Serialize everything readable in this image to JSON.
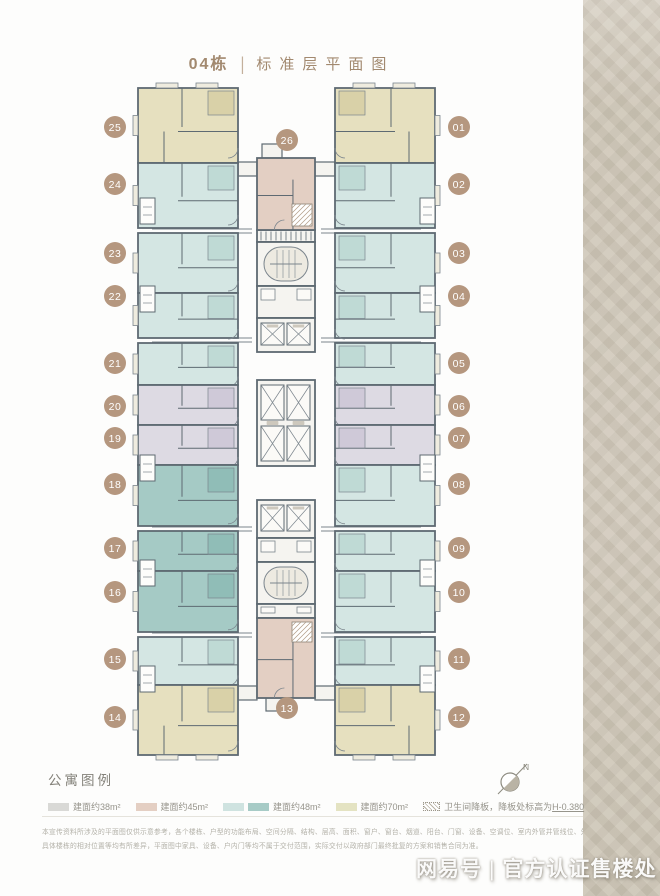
{
  "title": {
    "building": "04栋",
    "separator": "|",
    "name": "标准层平面图"
  },
  "legend": {
    "title": "公寓图例",
    "items": [
      {
        "label": "建面约38m²",
        "swatches": [
          "#d9d9d6"
        ]
      },
      {
        "label": "建面约45m²",
        "swatches": [
          "#e4cfc3"
        ]
      },
      {
        "label": "建面约48m²",
        "swatches": [
          "#cfe3e0",
          "#a7cbc6"
        ]
      },
      {
        "label": "建面约70m²",
        "swatches": [
          "#e4e3c2"
        ]
      },
      {
        "label": "卫生间降板，降板处标高为",
        "underlined": "H-0.380",
        "swatches": [
          "hatch"
        ]
      }
    ]
  },
  "compass": {
    "label": "N"
  },
  "disclaimer": {
    "line1": "本宣传资料所涉及的平面图仅供示意参考，各个楼栋、户型的功能布局、空间分隔、结构、层高、面积、窗户、窗台、烟道、阳台、门窗、设备、空调位、室内外管井管线位、外立面材质颜色、",
    "line2": "具体楼栋的相对位置等均有所差异，平面图中家具、设备、户内门等均不属于交付范围，实际交付以政府部门最终批复的方案和销售合同为准。"
  },
  "watermark": {
    "source": "网易号",
    "separator": "|",
    "text": "官方认证售楼处"
  },
  "colors": {
    "wall": "#5e6a72",
    "innerLine": "#7b858d",
    "coreFill": "#f5f4f0",
    "badge": "#b5977f",
    "badgeText": "#ffffff",
    "unitFill": {
      "70": "#e6e0bf",
      "48L": "#d4e6e3",
      "48D": "#a5cac5",
      "38": "#dddae3",
      "45": "#e3cfc3"
    },
    "unitDark": {
      "70": "#d9d1a8",
      "48L": "#bfdad5",
      "48D": "#90bdb7",
      "38": "#cfc9d8",
      "45": "#d5bcab"
    }
  },
  "plan": {
    "units": [
      {
        "no": "25",
        "fill": "70",
        "x": 138,
        "y": 88,
        "w": 100,
        "h": 75,
        "side": "left",
        "cap": "top",
        "badge": {
          "x": 115,
          "y": 127
        }
      },
      {
        "no": "24",
        "fill": "48L",
        "x": 138,
        "y": 163,
        "w": 100,
        "h": 65,
        "side": "left",
        "badge": {
          "x": 115,
          "y": 184
        }
      },
      {
        "no": "23",
        "fill": "48L",
        "x": 138,
        "y": 233,
        "w": 100,
        "h": 60,
        "side": "left",
        "badge": {
          "x": 115,
          "y": 253
        }
      },
      {
        "no": "22",
        "fill": "48L",
        "x": 138,
        "y": 293,
        "w": 100,
        "h": 45,
        "side": "left",
        "badge": {
          "x": 115,
          "y": 296
        }
      },
      {
        "no": "21",
        "fill": "48L",
        "x": 138,
        "y": 343,
        "w": 100,
        "h": 42,
        "side": "left",
        "badge": {
          "x": 115,
          "y": 363
        }
      },
      {
        "no": "20",
        "fill": "38",
        "x": 138,
        "y": 385,
        "w": 100,
        "h": 40,
        "side": "left",
        "badge": {
          "x": 115,
          "y": 406
        }
      },
      {
        "no": "19",
        "fill": "38",
        "x": 138,
        "y": 425,
        "w": 100,
        "h": 40,
        "side": "left",
        "badge": {
          "x": 115,
          "y": 438
        }
      },
      {
        "no": "18",
        "fill": "48D",
        "x": 138,
        "y": 465,
        "w": 100,
        "h": 61,
        "side": "left",
        "badge": {
          "x": 115,
          "y": 484
        }
      },
      {
        "no": "17",
        "fill": "48D",
        "x": 138,
        "y": 531,
        "w": 100,
        "h": 40,
        "side": "left",
        "badge": {
          "x": 115,
          "y": 548
        }
      },
      {
        "no": "16",
        "fill": "48D",
        "x": 138,
        "y": 571,
        "w": 100,
        "h": 61,
        "side": "left",
        "badge": {
          "x": 115,
          "y": 592
        }
      },
      {
        "no": "15",
        "fill": "48L",
        "x": 138,
        "y": 637,
        "w": 100,
        "h": 48,
        "side": "left",
        "badge": {
          "x": 115,
          "y": 659
        }
      },
      {
        "no": "14",
        "fill": "70",
        "x": 138,
        "y": 685,
        "w": 100,
        "h": 70,
        "side": "left",
        "cap": "bottom",
        "badge": {
          "x": 115,
          "y": 717
        }
      },
      {
        "no": "01",
        "fill": "70",
        "x": 335,
        "y": 88,
        "w": 100,
        "h": 75,
        "side": "right",
        "cap": "top",
        "badge": {
          "x": 459,
          "y": 127
        }
      },
      {
        "no": "02",
        "fill": "48L",
        "x": 335,
        "y": 163,
        "w": 100,
        "h": 65,
        "side": "right",
        "badge": {
          "x": 459,
          "y": 184
        }
      },
      {
        "no": "03",
        "fill": "48L",
        "x": 335,
        "y": 233,
        "w": 100,
        "h": 60,
        "side": "right",
        "badge": {
          "x": 459,
          "y": 253
        }
      },
      {
        "no": "04",
        "fill": "48L",
        "x": 335,
        "y": 293,
        "w": 100,
        "h": 45,
        "side": "right",
        "badge": {
          "x": 459,
          "y": 296
        }
      },
      {
        "no": "05",
        "fill": "48L",
        "x": 335,
        "y": 343,
        "w": 100,
        "h": 42,
        "side": "right",
        "badge": {
          "x": 459,
          "y": 363
        }
      },
      {
        "no": "06",
        "fill": "38",
        "x": 335,
        "y": 385,
        "w": 100,
        "h": 40,
        "side": "right",
        "badge": {
          "x": 459,
          "y": 406
        }
      },
      {
        "no": "07",
        "fill": "38",
        "x": 335,
        "y": 425,
        "w": 100,
        "h": 40,
        "side": "right",
        "badge": {
          "x": 459,
          "y": 438
        }
      },
      {
        "no": "08",
        "fill": "48L",
        "x": 335,
        "y": 465,
        "w": 100,
        "h": 61,
        "side": "right",
        "badge": {
          "x": 459,
          "y": 484
        }
      },
      {
        "no": "09",
        "fill": "48L",
        "x": 335,
        "y": 531,
        "w": 100,
        "h": 40,
        "side": "right",
        "badge": {
          "x": 459,
          "y": 548
        }
      },
      {
        "no": "10",
        "fill": "48L",
        "x": 335,
        "y": 571,
        "w": 100,
        "h": 61,
        "side": "right",
        "badge": {
          "x": 459,
          "y": 592
        }
      },
      {
        "no": "11",
        "fill": "48L",
        "x": 335,
        "y": 637,
        "w": 100,
        "h": 48,
        "side": "right",
        "badge": {
          "x": 459,
          "y": 659
        }
      },
      {
        "no": "12",
        "fill": "70",
        "x": 335,
        "y": 685,
        "w": 100,
        "h": 70,
        "side": "right",
        "cap": "bottom",
        "badge": {
          "x": 459,
          "y": 717
        }
      },
      {
        "no": "26",
        "fill": "45",
        "x": 257,
        "y": 158,
        "w": 58,
        "h": 72,
        "side": "center",
        "badge": {
          "x": 287,
          "y": 140
        }
      },
      {
        "no": "13",
        "fill": "45",
        "x": 257,
        "y": 618,
        "w": 58,
        "h": 80,
        "side": "center",
        "badge": {
          "x": 287,
          "y": 708
        }
      }
    ],
    "core": [
      {
        "kind": "louver",
        "x": 257,
        "y": 230,
        "w": 58,
        "h": 12
      },
      {
        "kind": "stair",
        "x": 257,
        "y": 242,
        "w": 58,
        "h": 44
      },
      {
        "kind": "lobby",
        "x": 257,
        "y": 286,
        "w": 58,
        "h": 32
      },
      {
        "kind": "elev2",
        "x": 257,
        "y": 318,
        "w": 58,
        "h": 34
      },
      {
        "kind": "elev4",
        "x": 257,
        "y": 380,
        "w": 58,
        "h": 86
      },
      {
        "kind": "elev2",
        "x": 257,
        "y": 500,
        "w": 58,
        "h": 38
      },
      {
        "kind": "lobby",
        "x": 257,
        "y": 538,
        "w": 58,
        "h": 24
      },
      {
        "kind": "stair",
        "x": 257,
        "y": 562,
        "w": 58,
        "h": 42
      },
      {
        "kind": "lobby",
        "x": 257,
        "y": 604,
        "w": 58,
        "h": 14
      }
    ],
    "bridges": [
      {
        "x": 238,
        "y": 162,
        "w": 19,
        "h": 14
      },
      {
        "x": 315,
        "y": 162,
        "w": 20,
        "h": 14
      },
      {
        "x": 238,
        "y": 686,
        "w": 19,
        "h": 14
      },
      {
        "x": 315,
        "y": 686,
        "w": 20,
        "h": 14
      },
      {
        "x": 262,
        "y": 144,
        "w": 20,
        "h": 14
      },
      {
        "x": 266,
        "y": 698,
        "w": 22,
        "h": 13
      }
    ],
    "corridors": [
      {
        "y": 229,
        "x1": 152,
        "x2": 252
      },
      {
        "y": 229,
        "x1": 321,
        "x2": 421
      },
      {
        "y": 338,
        "x1": 152,
        "x2": 252
      },
      {
        "y": 338,
        "x1": 321,
        "x2": 421
      },
      {
        "y": 527,
        "x1": 152,
        "x2": 252
      },
      {
        "y": 527,
        "x1": 321,
        "x2": 421
      },
      {
        "y": 633,
        "x1": 152,
        "x2": 252
      },
      {
        "y": 633,
        "x1": 321,
        "x2": 421
      }
    ],
    "shafts": [
      {
        "x": 140,
        "y": 198
      },
      {
        "x": 140,
        "y": 286
      },
      {
        "x": 140,
        "y": 455
      },
      {
        "x": 140,
        "y": 560
      },
      {
        "x": 140,
        "y": 666
      },
      {
        "x": 420,
        "y": 198
      },
      {
        "x": 420,
        "y": 286
      },
      {
        "x": 420,
        "y": 455
      },
      {
        "x": 420,
        "y": 560
      },
      {
        "x": 420,
        "y": 666
      }
    ],
    "sunken": [
      {
        "x": 292,
        "y": 204,
        "w": 20,
        "h": 22
      },
      {
        "x": 292,
        "y": 622,
        "w": 20,
        "h": 20
      }
    ]
  }
}
